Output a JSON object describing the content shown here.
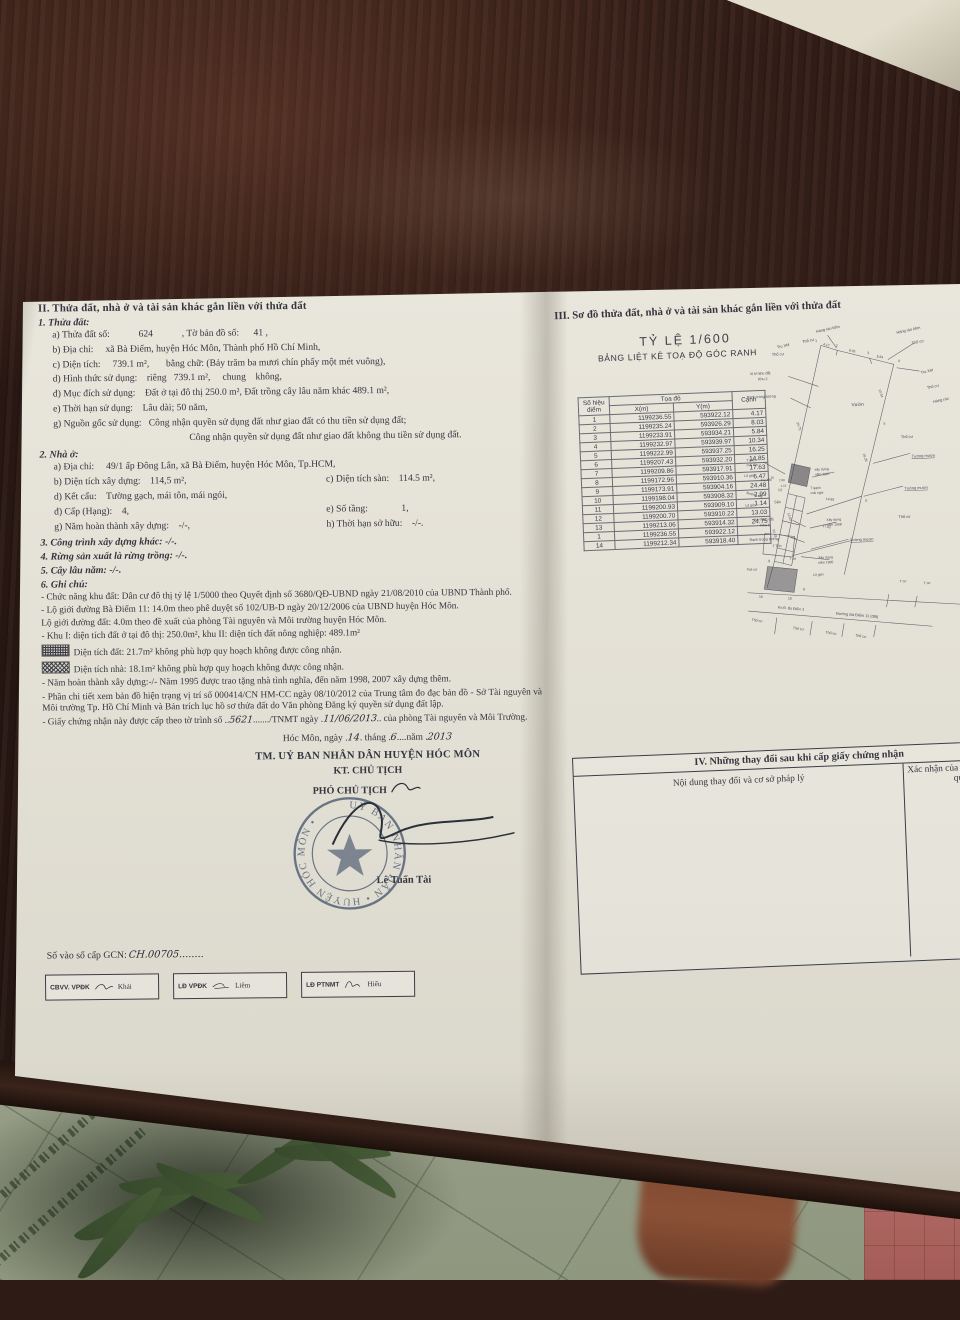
{
  "colors": {
    "wood": "#2e1b16",
    "paper": "#e6e3d8",
    "ink": "#35353f",
    "stamp": "#4c5a70",
    "tile": "#99a08a",
    "leaf": "#3f5231",
    "skin": "#7c4630",
    "pink": "#b06a64"
  },
  "left": {
    "header": "II. Thửa đất, nhà ở và tài sản khác gắn liền với thửa đất",
    "s1_title": "1. Thửa đất:",
    "s1": [
      "a) Thửa đất số:            624            , Tờ bản đồ số:      41 ,",
      "b) Địa chỉ:     xã Bà Điểm, huyện Hóc Môn, Thành phố Hồ Chí Minh,",
      "c) Diện tích:     739.1 m²,       bằng chữ: (Bảy trăm ba mươi chín phẩy một mét vuông),",
      "d) Hình thức sử dụng:    riêng   739.1 m²,     chung    không,",
      "đ) Mục đích sử dụng:    Đất ở tại đô thị 250.0 m², Đất trồng cây lâu năm khác 489.1 m²,",
      "e) Thời hạn sử dụng:    Lâu dài; 50 năm,",
      "g) Nguồn gốc sử dụng:   Công nhận quyền sử dụng đất như giao đất có thu tiền sử dụng đất;",
      "Công nhận quyền sử dụng đất như giao đất không thu tiền sử dụng đất."
    ],
    "s2_title": "2. Nhà ở:",
    "s2a": "a) Địa chỉ:     49/1 ấp Đông Lân, xã Bà Điểm, huyện Hóc Môn, Tp.HCM,",
    "s2b": "b) Diện tích xây dựng:    114,5 m²,",
    "s2c": "c) Diện tích sàn:    114.5 m²,",
    "s2d": "d) Kết cấu:    Tường gạch, mái tôn, mái ngói,",
    "s2dd": "đ) Cấp (Hạng):    4,",
    "s2e": "e) Số tầng:              1,",
    "s2g": "g) Năm hoàn thành xây dựng:    -/-,",
    "s2h": "h) Thời hạn sở hữu:    -/-.",
    "s3": "3. Công trình xây dựng khác: -/-.",
    "s4": "4. Rừng sản xuất là rừng trồng: -/-.",
    "s5": "5. Cây lâu năm: -/-.",
    "s6_title": "6. Ghi chú:",
    "notes": [
      {
        "text": "- Chức năng khu đất: Dân cư đô thị tỷ lệ 1/5000 theo Quyết định số 3680/QĐ-UBND ngày 21/08/2010 của UBND Thành phố."
      },
      {
        "text": "- Lộ giới đường Bà Điểm 11: 14.0m theo phê duyệt số 102/UB-D ngày 20/12/2006 của UBND huyện Hóc Môn."
      },
      {
        "text": "Lộ giới đường đất: 4.0m theo đề xuất của phòng Tài nguyên và Môi trường huyện Hóc Môn."
      },
      {
        "text": "- Khu I: diện tích đất ở tại đô thị: 250.0m², khu II: diện tích đất nông nghiệp: 489.1m²"
      },
      {
        "text": "Diện tích đất: 21.7m² không phù hợp quy hoạch không được công nhận."
      },
      {
        "text": "Diện tích nhà: 18.1m² không phù hợp quy hoạch không được công nhận."
      },
      {
        "text": "- Năm hoàn thành xây dựng:-/- Năm 1995 được trao tặng nhà tình nghĩa, đến năm 1998, 2007 xây dựng thêm."
      },
      {
        "text": "- Phần chi tiết xem bản đồ hiện trạng vị trí số 000414/CN HM-CC ngày 08/10/2012 của Trung tâm đo đạc bản đồ - Sở Tài nguyên và Môi trường Tp. Hồ Chí Minh và Bản trích lục hồ sơ thửa đất do Văn phòng Đăng ký quyền sử dụng đất lập."
      }
    ],
    "cert": {
      "pre": "- Giấy chứng nhận này được cấp theo tờ trình số ..",
      "hw1": "5621",
      "mid": "......./TNMT ngày .",
      "hw2": "11/06/2013",
      "post": ".. của phòng Tài nguyên và Môi Trường."
    },
    "date": {
      "p1": "Hóc Môn, ngày .",
      "d": "14",
      "p2": ". tháng .",
      "m": "6",
      "p3": "....năm .",
      "y": "2013"
    },
    "sign": {
      "tm": "TM. UỶ BAN NHÂN DÂN HUYỆN HÓC MÔN",
      "kt": "KT. CHỦ TỊCH",
      "deputy": "PHÓ CHỦ TỊCH",
      "name": "Lê Tuấn Tài"
    },
    "stamp_text": "UỶ BAN NHÂN DÂN • HUYỆN HÓC MÔN •",
    "serial_label": "Số vào sổ cấp GCN:",
    "serial_value": "CH.00705........",
    "boxes": [
      {
        "label": "CBVV. VPĐK",
        "name": "Khải"
      },
      {
        "label": "LĐ VPĐK",
        "name": "Liêm"
      },
      {
        "label": "LĐ PTNMT",
        "name": "Hiếu"
      }
    ]
  },
  "right": {
    "header": "III. Sơ đồ thửa đất, nhà ở và tài sản khác gắn liền với thửa đất",
    "scale": "TỶ LỆ 1/600",
    "table_title": "BẢNG LIỆT KÊ TOẠ ĐỘ GÓC RANH",
    "coord_table": {
      "col_point": "Số hiệu điểm",
      "col_group": "Tọa độ",
      "col_x": "X(m)",
      "col_y": "Y(m)",
      "col_edge": "Cạnh",
      "rows": [
        [
          "1",
          "1199236.55",
          "593922.12",
          "4.17"
        ],
        [
          "2",
          "1199235.24",
          "593926.29",
          "8.03"
        ],
        [
          "3",
          "1199233.91",
          "593934.21",
          "5.84"
        ],
        [
          "4",
          "1199232.97",
          "593939.97",
          "10.34"
        ],
        [
          "5",
          "1199222.99",
          "593937.25",
          "16.25"
        ],
        [
          "6",
          "1199207.43",
          "593932.20",
          "14.85"
        ],
        [
          "7",
          "1199209.86",
          "593917.91",
          "17.63"
        ],
        [
          "8",
          "1199172.96",
          "593910.36",
          "6.47"
        ],
        [
          "9",
          "1199173.91",
          "593904.16",
          "24.48"
        ],
        [
          "10",
          "1199198.04",
          "593908.32",
          "2.99"
        ],
        [
          "11",
          "1199200.93",
          "593909.10",
          "1.14"
        ],
        [
          "12",
          "1199200.70",
          "593910.22",
          "13.03"
        ],
        [
          "13",
          "1199213.06",
          "593914.32",
          "24.75"
        ],
        [
          "1",
          "1199236.55",
          "593922.12",
          ""
        ],
        [
          "14",
          "1199212.34",
          "593918.40",
          ""
        ]
      ]
    },
    "s4box": {
      "title": "IV. Những thay đổi sau khi cấp giấy chứng nhận",
      "col1": "Nội dung thay đổi và cơ sở pháp lý",
      "col2": "Xác nhận của cơ quan có thẩm quyền"
    }
  },
  "map": {
    "labels": [
      {
        "t": "Hàng rào kẽm",
        "x": 112,
        "y": 24,
        "r": -10,
        "s": 5.5
      },
      {
        "t": "Thổ cư",
        "x": 92,
        "y": 38,
        "r": -10,
        "s": 5.5
      },
      {
        "t": "Trụ XM",
        "x": 56,
        "y": 44,
        "r": -10,
        "s": 5.5
      },
      {
        "t": "1",
        "x": 110,
        "y": 37,
        "s": 5
      },
      {
        "t": "4.17",
        "x": 121,
        "y": 42,
        "r": 14,
        "s": 4.8
      },
      {
        "t": "2",
        "x": 139,
        "y": 45,
        "s": 5
      },
      {
        "t": "8.03",
        "x": 157,
        "y": 52,
        "r": 14,
        "s": 4.8
      },
      {
        "t": "3",
        "x": 183,
        "y": 57,
        "s": 5
      },
      {
        "t": "5.84",
        "x": 196,
        "y": 62,
        "r": 14,
        "s": 4.8
      },
      {
        "t": "4",
        "x": 226,
        "y": 70,
        "s": 5
      },
      {
        "t": "Hàng rào kẽm",
        "x": 226,
        "y": 30,
        "r": -10,
        "s": 5.5
      },
      {
        "t": "Thổ cư",
        "x": 247,
        "y": 46,
        "r": -10,
        "s": 5.5
      },
      {
        "t": "Trụ XM",
        "x": 258,
        "y": 88,
        "r": -10,
        "s": 5.5
      },
      {
        "t": "Thổ cư",
        "x": 266,
        "y": 110,
        "r": -10,
        "s": 5.5
      },
      {
        "t": "Hàng rào",
        "x": 274,
        "y": 130,
        "r": -10,
        "s": 5.5
      },
      {
        "t": "10.34",
        "x": 197,
        "y": 108,
        "r": 74,
        "s": 4.8
      },
      {
        "t": "5",
        "x": 202,
        "y": 158,
        "s": 5
      },
      {
        "t": "16.25",
        "x": 171,
        "y": 198,
        "r": 74,
        "s": 4.8
      },
      {
        "t": "Thổ cư",
        "x": 226,
        "y": 178,
        "s": 5.5
      },
      {
        "t": "Tường mượn",
        "x": 240,
        "y": 206,
        "s": 5.5,
        "u": true
      },
      {
        "t": "6",
        "x": 172,
        "y": 266,
        "s": 5
      },
      {
        "t": "14.85",
        "x": 116,
        "y": 261,
        "r": 8,
        "s": 4.8
      },
      {
        "t": "Tường mượn",
        "x": 228,
        "y": 251,
        "s": 5.5,
        "u": true
      },
      {
        "t": "Vườn",
        "x": 158,
        "y": 130,
        "s": 6.8
      },
      {
        "t": "Thổ cư",
        "x": 48,
        "y": 54,
        "s": 5.5
      },
      {
        "t": "Vị trí khu đất",
        "x": 16,
        "y": 80,
        "s": 5.2
      },
      {
        "t": "Khu 2",
        "x": 27,
        "y": 88,
        "s": 5.2
      },
      {
        "t": "Ranh trùng tường",
        "x": 10,
        "y": 113,
        "s": 5.2
      },
      {
        "t": "24.75",
        "x": 79,
        "y": 150,
        "r": 74,
        "s": 4.8
      },
      {
        "t": "13",
        "x": 49,
        "y": 246,
        "s": 5
      },
      {
        "t": "T gạch",
        "x": 6,
        "y": 202,
        "s": 4.8
      },
      {
        "t": "mái tôn",
        "x": 6,
        "y": 209,
        "s": 4.8
      },
      {
        "t": "xây dựng",
        "x": 102,
        "y": 219,
        "s": 4.8
      },
      {
        "t": "năm 2007",
        "x": 102,
        "y": 226,
        "s": 4.8
      },
      {
        "t": "T gạch",
        "x": 95,
        "y": 245,
        "s": 4.8
      },
      {
        "t": "mái ngói",
        "x": 95,
        "y": 252,
        "s": 4.8
      },
      {
        "t": "Sân",
        "x": 43,
        "y": 263,
        "s": 5.2
      },
      {
        "t": "Lộ giới",
        "x": 2,
        "y": 224,
        "s": 4.8
      },
      {
        "t": "Trụ XM",
        "x": 25,
        "y": 231,
        "s": 4.8
      },
      {
        "t": "Đường đất",
        "x": 4,
        "y": 248,
        "r": 16,
        "s": 4.8
      },
      {
        "t": "Lộ giới",
        "x": 2,
        "y": 266,
        "s": 4.8
      },
      {
        "t": "10",
        "x": 39,
        "y": 228,
        "s": 4.5
      },
      {
        "t": "2.99",
        "x": 51,
        "y": 232,
        "s": 4.2
      },
      {
        "t": "1.14",
        "x": 53,
        "y": 240,
        "s": 4.2
      },
      {
        "t": "13.03",
        "x": 61,
        "y": 278,
        "r": 74,
        "s": 4.5
      },
      {
        "t": "17.63",
        "x": 110,
        "y": 299,
        "r": 14,
        "s": 4.5
      },
      {
        "t": "Vị trí khu đất",
        "x": 12,
        "y": 287,
        "s": 5.2
      },
      {
        "t": "Khu 1",
        "x": 22,
        "y": 295,
        "s": 5.2
      },
      {
        "t": "Ranh trùng tường",
        "x": 6,
        "y": 315,
        "s": 5.2
      },
      {
        "t": "24.48",
        "x": 39,
        "y": 300,
        "r": 76,
        "s": 4.8
      },
      {
        "t": "Xây dựng",
        "x": 116,
        "y": 291,
        "s": 4.8
      },
      {
        "t": "năm 1998",
        "x": 116,
        "y": 298,
        "s": 4.8
      },
      {
        "t": "Tường mượn",
        "x": 148,
        "y": 321,
        "s": 5.5,
        "u": true
      },
      {
        "t": "Xây dựng",
        "x": 102,
        "y": 344,
        "s": 4.8
      },
      {
        "t": "năm 1995",
        "x": 102,
        "y": 351,
        "s": 4.8
      },
      {
        "t": "Thổ cư",
        "x": 218,
        "y": 291,
        "s": 5.5
      },
      {
        "t": "T Tôn",
        "x": 38,
        "y": 325,
        "s": 5
      },
      {
        "t": "T cư",
        "x": 61,
        "y": 344,
        "s": 4.8
      },
      {
        "t": "Thổ cư",
        "x": 0,
        "y": 357,
        "s": 4.8
      },
      {
        "t": "9",
        "x": 31,
        "y": 346,
        "s": 5
      },
      {
        "t": "16",
        "x": 16,
        "y": 396,
        "s": 5
      },
      {
        "t": "15",
        "x": 57,
        "y": 400,
        "s": 5
      },
      {
        "t": "8",
        "x": 79,
        "y": 388,
        "s": 5
      },
      {
        "t": "Lộ giới",
        "x": 94,
        "y": 368,
        "s": 4.8
      },
      {
        "t": "T cư",
        "x": 216,
        "y": 382,
        "s": 4.8
      },
      {
        "t": "T cư",
        "x": 250,
        "y": 386,
        "s": 4.8
      },
      {
        "t": "Ra Đ. Bà Điểm 3",
        "x": 42,
        "y": 412,
        "r": 7,
        "s": 5
      },
      {
        "t": "Đường Bà Điểm 11 (đất)",
        "x": 124,
        "y": 424,
        "r": 7,
        "s": 5.5
      },
      {
        "t": "Thổ cư",
        "x": 4,
        "y": 428,
        "r": 10,
        "s": 5
      },
      {
        "t": "Thổ cư",
        "x": 62,
        "y": 442,
        "r": 10,
        "s": 5
      },
      {
        "t": "Thổ cư",
        "x": 108,
        "y": 450,
        "r": 10,
        "s": 5
      },
      {
        "t": "Thổ cư",
        "x": 150,
        "y": 456,
        "r": 10,
        "s": 5
      }
    ]
  }
}
